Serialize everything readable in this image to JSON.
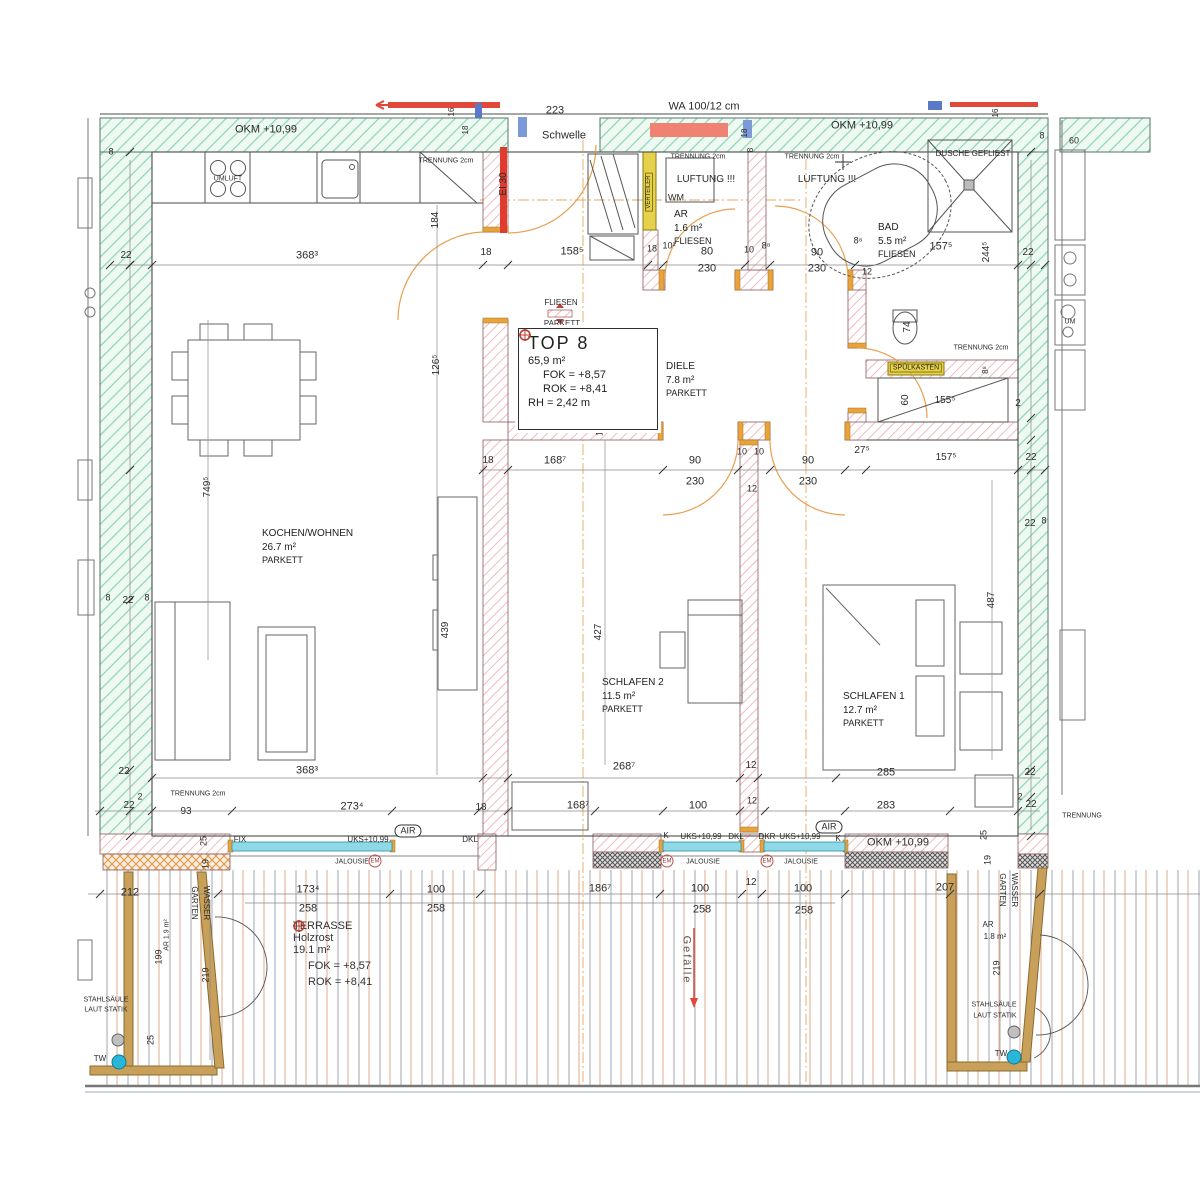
{
  "title": "TOP 8 Grundriss",
  "top8_box": {
    "title": "TOP 8",
    "area": "65,9 m²",
    "fok": "FOK = +8,57",
    "rok": "ROK = +8,41",
    "rh": "RH = 2,42 m"
  },
  "terrasse": {
    "name": "TERRASSE",
    "sub": "Holzrost",
    "area": "19.1 m²",
    "fok": "FOK = +8,57",
    "rok": "ROK = +8,41"
  },
  "rooms": {
    "kochen": {
      "name": "KOCHEN/WOHNEN",
      "area": "26.7 m²",
      "floor": "PARKETT"
    },
    "schlafen2": {
      "name": "SCHLAFEN 2",
      "area": "11.5 m²",
      "floor": "PARKETT"
    },
    "schlafen1": {
      "name": "SCHLAFEN 1",
      "area": "12.7 m²",
      "floor": "PARKETT"
    },
    "diele": {
      "name": "DIELE",
      "area": "7.8 m²",
      "floor": "PARKETT"
    },
    "bad": {
      "name": "BAD",
      "area": "5.5 m²",
      "floor": "FLIESEN"
    },
    "ar": {
      "name": "AR",
      "area": "1.6 m²",
      "floor": "FLIESEN"
    }
  },
  "colors": {
    "wall_green": "#8fd4b4",
    "wall_red": "#f0a8b0",
    "window_cyan": "#8fd9e6",
    "wood_tan": "#c8a05a",
    "accent_red": "#e0493a",
    "fok_green": "#2e7d5b",
    "rok_red": "#c0392b"
  },
  "labels": [
    {
      "t": "OKM +10,99",
      "x": 266,
      "y": 130,
      "s": 11
    },
    {
      "t": "OKM +10,99",
      "x": 862,
      "y": 126,
      "s": 11
    },
    {
      "t": "OKM +10,99",
      "x": 898,
      "y": 843,
      "s": 11
    },
    {
      "t": "223",
      "x": 555,
      "y": 111,
      "s": 11
    },
    {
      "t": "Schwelle",
      "x": 564,
      "y": 136,
      "s": 11
    },
    {
      "t": "WA 100/12 cm",
      "x": 704,
      "y": 107,
      "s": 11
    },
    {
      "t": "EI 30",
      "x": 504,
      "y": 184,
      "s": 10,
      "r": -90
    },
    {
      "t": "TRENNUNG 2cm",
      "x": 446,
      "y": 161,
      "s": 7
    },
    {
      "t": "UMLUFT",
      "x": 228,
      "y": 179,
      "s": 7
    },
    {
      "t": "TRENNUNG 2cm",
      "x": 698,
      "y": 157,
      "s": 7
    },
    {
      "t": "LUFTUNG !!!",
      "x": 706,
      "y": 180,
      "s": 10
    },
    {
      "t": "WM",
      "x": 676,
      "y": 198,
      "s": 9
    },
    {
      "t": "TRENNUNG 2cm",
      "x": 812,
      "y": 157,
      "s": 7
    },
    {
      "t": "LUFTUNG !!!",
      "x": 827,
      "y": 180,
      "s": 10
    },
    {
      "t": "DUSCHE GEFLIEST",
      "x": 973,
      "y": 154,
      "s": 8
    },
    {
      "t": "8",
      "x": 111,
      "y": 152,
      "s": 9
    },
    {
      "t": "22",
      "x": 126,
      "y": 256,
      "s": 10
    },
    {
      "t": "368³",
      "x": 307,
      "y": 256,
      "s": 11
    },
    {
      "t": "184",
      "x": 436,
      "y": 220,
      "s": 10,
      "r": -90
    },
    {
      "t": "18",
      "x": 486,
      "y": 253,
      "s": 10
    },
    {
      "t": "158⁵",
      "x": 572,
      "y": 252,
      "s": 11
    },
    {
      "t": "18",
      "x": 652,
      "y": 249,
      "s": 9
    },
    {
      "t": "10²",
      "x": 669,
      "y": 246,
      "s": 9
    },
    {
      "t": "80",
      "x": 707,
      "y": 252,
      "s": 11
    },
    {
      "t": "230",
      "x": 707,
      "y": 269,
      "s": 11
    },
    {
      "t": "10",
      "x": 749,
      "y": 250,
      "s": 9
    },
    {
      "t": "8⁸",
      "x": 766,
      "y": 246,
      "s": 9
    },
    {
      "t": "90",
      "x": 817,
      "y": 253,
      "s": 11
    },
    {
      "t": "230",
      "x": 817,
      "y": 269,
      "s": 11
    },
    {
      "t": "8⁸",
      "x": 858,
      "y": 241,
      "s": 9
    },
    {
      "t": "12",
      "x": 867,
      "y": 272,
      "s": 9
    },
    {
      "t": "157⁵",
      "x": 941,
      "y": 247,
      "s": 11
    },
    {
      "t": "244⁵",
      "x": 987,
      "y": 252,
      "s": 10,
      "r": -90
    },
    {
      "t": "22",
      "x": 1028,
      "y": 253,
      "s": 10
    },
    {
      "t": "16",
      "x": 452,
      "y": 112,
      "s": 8,
      "r": -90
    },
    {
      "t": "18",
      "x": 466,
      "y": 130,
      "s": 8,
      "r": -90
    },
    {
      "t": "18",
      "x": 745,
      "y": 133,
      "s": 8,
      "r": -90
    },
    {
      "t": "8",
      "x": 751,
      "y": 150,
      "s": 8,
      "r": -90
    },
    {
      "t": "16",
      "x": 996,
      "y": 113,
      "s": 8,
      "r": -90
    },
    {
      "t": "8",
      "x": 1042,
      "y": 136,
      "s": 9
    },
    {
      "t": "60",
      "x": 1074,
      "y": 141,
      "s": 9
    },
    {
      "t": "FLIESEN",
      "x": 561,
      "y": 303,
      "s": 8
    },
    {
      "t": "PARKETT",
      "x": 562,
      "y": 324,
      "s": 8
    },
    {
      "t": "12",
      "x": 600,
      "y": 431,
      "s": 9,
      "r": -90
    },
    {
      "t": "74",
      "x": 908,
      "y": 327,
      "s": 10,
      "r": -90
    },
    {
      "t": "SPÜLKASTEN",
      "x": 916,
      "y": 368,
      "s": 7,
      "k": "ybox"
    },
    {
      "t": "TRENNUNG 2cm",
      "x": 981,
      "y": 348,
      "s": 7
    },
    {
      "t": "8⁸",
      "x": 986,
      "y": 370,
      "s": 8,
      "r": -90
    },
    {
      "t": "60",
      "x": 906,
      "y": 400,
      "s": 10,
      "r": -90
    },
    {
      "t": "155⁵",
      "x": 945,
      "y": 401,
      "s": 10
    },
    {
      "t": "2",
      "x": 1018,
      "y": 404,
      "s": 10
    },
    {
      "t": "27⁵",
      "x": 862,
      "y": 451,
      "s": 10
    },
    {
      "t": "157⁵",
      "x": 946,
      "y": 458,
      "s": 10
    },
    {
      "t": "22",
      "x": 1031,
      "y": 458,
      "s": 10
    },
    {
      "t": "18",
      "x": 488,
      "y": 461,
      "s": 10
    },
    {
      "t": "168⁷",
      "x": 555,
      "y": 461,
      "s": 11
    },
    {
      "t": "90",
      "x": 695,
      "y": 461,
      "s": 11
    },
    {
      "t": "230",
      "x": 695,
      "y": 482,
      "s": 11
    },
    {
      "t": "10",
      "x": 742,
      "y": 452,
      "s": 9
    },
    {
      "t": "10",
      "x": 759,
      "y": 452,
      "s": 9
    },
    {
      "t": "12",
      "x": 752,
      "y": 489,
      "s": 9
    },
    {
      "t": "90",
      "x": 808,
      "y": 461,
      "s": 11
    },
    {
      "t": "230",
      "x": 808,
      "y": 482,
      "s": 11
    },
    {
      "t": "749⁵",
      "x": 208,
      "y": 487,
      "s": 10,
      "r": -90
    },
    {
      "t": "126⁵",
      "x": 437,
      "y": 365,
      "s": 10,
      "r": -90
    },
    {
      "t": "439",
      "x": 446,
      "y": 630,
      "s": 10,
      "r": -90
    },
    {
      "t": "427",
      "x": 599,
      "y": 632,
      "s": 10,
      "r": -90
    },
    {
      "t": "487",
      "x": 992,
      "y": 600,
      "s": 10,
      "r": -90
    },
    {
      "t": "268⁷",
      "x": 624,
      "y": 767,
      "s": 11
    },
    {
      "t": "12",
      "x": 751,
      "y": 766,
      "s": 10
    },
    {
      "t": "285",
      "x": 886,
      "y": 773,
      "s": 11
    },
    {
      "t": "22",
      "x": 1030,
      "y": 773,
      "s": 10
    },
    {
      "t": "2",
      "x": 1020,
      "y": 797,
      "s": 9
    },
    {
      "t": "22",
      "x": 1031,
      "y": 805,
      "s": 10
    },
    {
      "t": "368³",
      "x": 307,
      "y": 771,
      "s": 11
    },
    {
      "t": "8",
      "x": 108,
      "y": 598,
      "s": 9
    },
    {
      "t": "22",
      "x": 128,
      "y": 601,
      "s": 10
    },
    {
      "t": "8",
      "x": 147,
      "y": 598,
      "s": 9
    },
    {
      "t": "22",
      "x": 124,
      "y": 772,
      "s": 10
    },
    {
      "t": "TRENNUNG 2cm",
      "x": 198,
      "y": 794,
      "s": 7
    },
    {
      "t": "93",
      "x": 186,
      "y": 812,
      "s": 10
    },
    {
      "t": "22",
      "x": 129,
      "y": 806,
      "s": 10
    },
    {
      "t": "2",
      "x": 140,
      "y": 797,
      "s": 9
    },
    {
      "t": "273⁴",
      "x": 352,
      "y": 807,
      "s": 11
    },
    {
      "t": "18",
      "x": 481,
      "y": 808,
      "s": 10
    },
    {
      "t": "168⁷",
      "x": 578,
      "y": 806,
      "s": 11
    },
    {
      "t": "100",
      "x": 698,
      "y": 806,
      "s": 11
    },
    {
      "t": "12",
      "x": 752,
      "y": 801,
      "s": 9
    },
    {
      "t": "283",
      "x": 886,
      "y": 806,
      "s": 11
    },
    {
      "t": "K",
      "x": 666,
      "y": 836,
      "s": 8
    },
    {
      "t": "UKS+10,99",
      "x": 701,
      "y": 837,
      "s": 8
    },
    {
      "t": "DKL",
      "x": 736,
      "y": 837,
      "s": 8
    },
    {
      "t": "DKR",
      "x": 767,
      "y": 837,
      "s": 8
    },
    {
      "t": "UKS+10,99",
      "x": 800,
      "y": 837,
      "s": 8
    },
    {
      "t": "K",
      "x": 838,
      "y": 839,
      "s": 8
    },
    {
      "t": "AIR",
      "x": 829,
      "y": 827,
      "s": 9,
      "k": "oval"
    },
    {
      "t": "FIX",
      "x": 240,
      "y": 840,
      "s": 8
    },
    {
      "t": "UKS+10,99",
      "x": 368,
      "y": 840,
      "s": 8
    },
    {
      "t": "AIR",
      "x": 408,
      "y": 831,
      "s": 9,
      "k": "oval"
    },
    {
      "t": "DKL",
      "x": 470,
      "y": 840,
      "s": 8
    },
    {
      "t": "JALOUSIE",
      "x": 352,
      "y": 862,
      "s": 7
    },
    {
      "t": "EM",
      "x": 375,
      "y": 861,
      "s": 6,
      "k": "circ"
    },
    {
      "t": "JALOUSIE",
      "x": 703,
      "y": 862,
      "s": 7
    },
    {
      "t": "EM",
      "x": 667,
      "y": 861,
      "s": 6,
      "k": "circ"
    },
    {
      "t": "JALOUSIE",
      "x": 801,
      "y": 862,
      "s": 7
    },
    {
      "t": "EM",
      "x": 767,
      "y": 861,
      "s": 6,
      "k": "circ"
    },
    {
      "t": "25",
      "x": 204,
      "y": 841,
      "s": 9,
      "r": -90
    },
    {
      "t": "19",
      "x": 206,
      "y": 864,
      "s": 9,
      "r": -90
    },
    {
      "t": "WASSER",
      "x": 206,
      "y": 903,
      "s": 8,
      "r": 90
    },
    {
      "t": "GARTEN",
      "x": 194,
      "y": 903,
      "s": 8,
      "r": 90
    },
    {
      "t": "25",
      "x": 984,
      "y": 835,
      "s": 9,
      "r": -90
    },
    {
      "t": "19",
      "x": 988,
      "y": 860,
      "s": 9,
      "r": -90
    },
    {
      "t": "WASSER",
      "x": 1014,
      "y": 890,
      "s": 8,
      "r": 90
    },
    {
      "t": "GARTEN",
      "x": 1002,
      "y": 890,
      "s": 8,
      "r": 90
    },
    {
      "t": "212",
      "x": 130,
      "y": 893,
      "s": 11
    },
    {
      "t": "173⁴",
      "x": 308,
      "y": 890,
      "s": 11
    },
    {
      "t": "258",
      "x": 308,
      "y": 909,
      "s": 11
    },
    {
      "t": "100",
      "x": 436,
      "y": 890,
      "s": 11
    },
    {
      "t": "258",
      "x": 436,
      "y": 909,
      "s": 11
    },
    {
      "t": "186⁷",
      "x": 600,
      "y": 889,
      "s": 11
    },
    {
      "t": "100",
      "x": 700,
      "y": 889,
      "s": 11
    },
    {
      "t": "258",
      "x": 702,
      "y": 910,
      "s": 11
    },
    {
      "t": "12",
      "x": 751,
      "y": 883,
      "s": 10
    },
    {
      "t": "100",
      "x": 803,
      "y": 889,
      "s": 11
    },
    {
      "t": "258",
      "x": 804,
      "y": 911,
      "s": 11
    },
    {
      "t": "207",
      "x": 945,
      "y": 888,
      "s": 11
    },
    {
      "t": "Gefälle",
      "x": 686,
      "y": 960,
      "s": 11,
      "r": 90,
      "k": "ge"
    },
    {
      "t": "AR 1.9 m²",
      "x": 167,
      "y": 935,
      "s": 7,
      "r": -90
    },
    {
      "t": "199",
      "x": 159,
      "y": 957,
      "s": 9,
      "r": -90
    },
    {
      "t": "219",
      "x": 206,
      "y": 975,
      "s": 9,
      "r": -90
    },
    {
      "t": "25",
      "x": 151,
      "y": 1040,
      "s": 9,
      "r": -90
    },
    {
      "t": "STAHLSÄULE",
      "x": 106,
      "y": 1000,
      "s": 7
    },
    {
      "t": "LAUT STATIK",
      "x": 106,
      "y": 1010,
      "s": 7
    },
    {
      "t": "TW",
      "x": 100,
      "y": 1059,
      "s": 8
    },
    {
      "t": "AR",
      "x": 988,
      "y": 925,
      "s": 8
    },
    {
      "t": "1.8 m²",
      "x": 995,
      "y": 937,
      "s": 8
    },
    {
      "t": "219",
      "x": 997,
      "y": 968,
      "s": 9,
      "r": -90
    },
    {
      "t": "STAHLSÄULE",
      "x": 994,
      "y": 1005,
      "s": 7
    },
    {
      "t": "LAUT STATIK",
      "x": 995,
      "y": 1016,
      "s": 7
    },
    {
      "t": "TW",
      "x": 1001,
      "y": 1054,
      "s": 8
    },
    {
      "t": "TRENNUNG",
      "x": 1082,
      "y": 816,
      "s": 7
    },
    {
      "t": "UM",
      "x": 1070,
      "y": 322,
      "s": 7
    },
    {
      "t": "22",
      "x": 1030,
      "y": 524,
      "s": 10
    },
    {
      "t": "8",
      "x": 1044,
      "y": 521,
      "s": 9
    },
    {
      "t": "VERTEILER",
      "x": 649,
      "y": 192,
      "s": 6,
      "r": -90,
      "k": "ybox"
    }
  ]
}
